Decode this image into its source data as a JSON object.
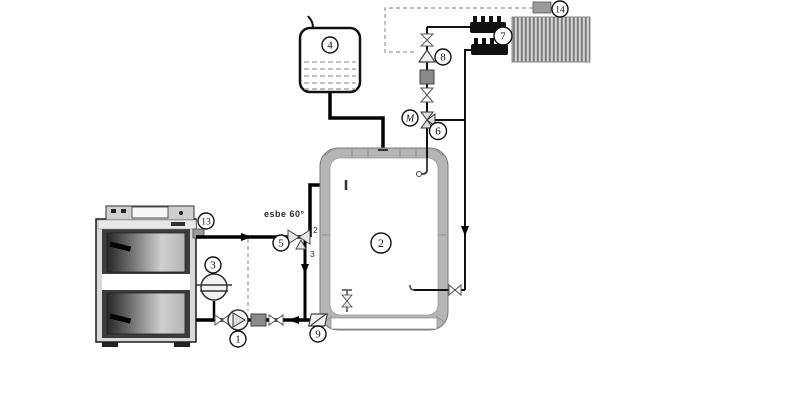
{
  "colors": {
    "background": "#ffffff",
    "ink": "#111111",
    "tank_wall": "#b5b5b5",
    "component_gray": "#8a8a8a",
    "dashed_line": "#9a9a9a",
    "radiator_fill": "#d6d6d6",
    "radiator_stripe": "#7c7c7c"
  },
  "callouts": {
    "boiler_pump": "1",
    "buffer_tank": "2",
    "expansion_vessel": "3",
    "open_expansion_tank": "4",
    "thermic_valve": "5",
    "mixing_valve": "6",
    "radiator_circuit": "7",
    "zone_valve": "8",
    "check_valve": "9",
    "boiler_thermostat": "13",
    "room_thermostat": "14",
    "mixing_valve_motor": "M"
  },
  "annotations": {
    "thermic_valve_label": "esbe 60°",
    "thermic_valve_port_top": "2",
    "thermic_valve_port_bottom": "3"
  }
}
